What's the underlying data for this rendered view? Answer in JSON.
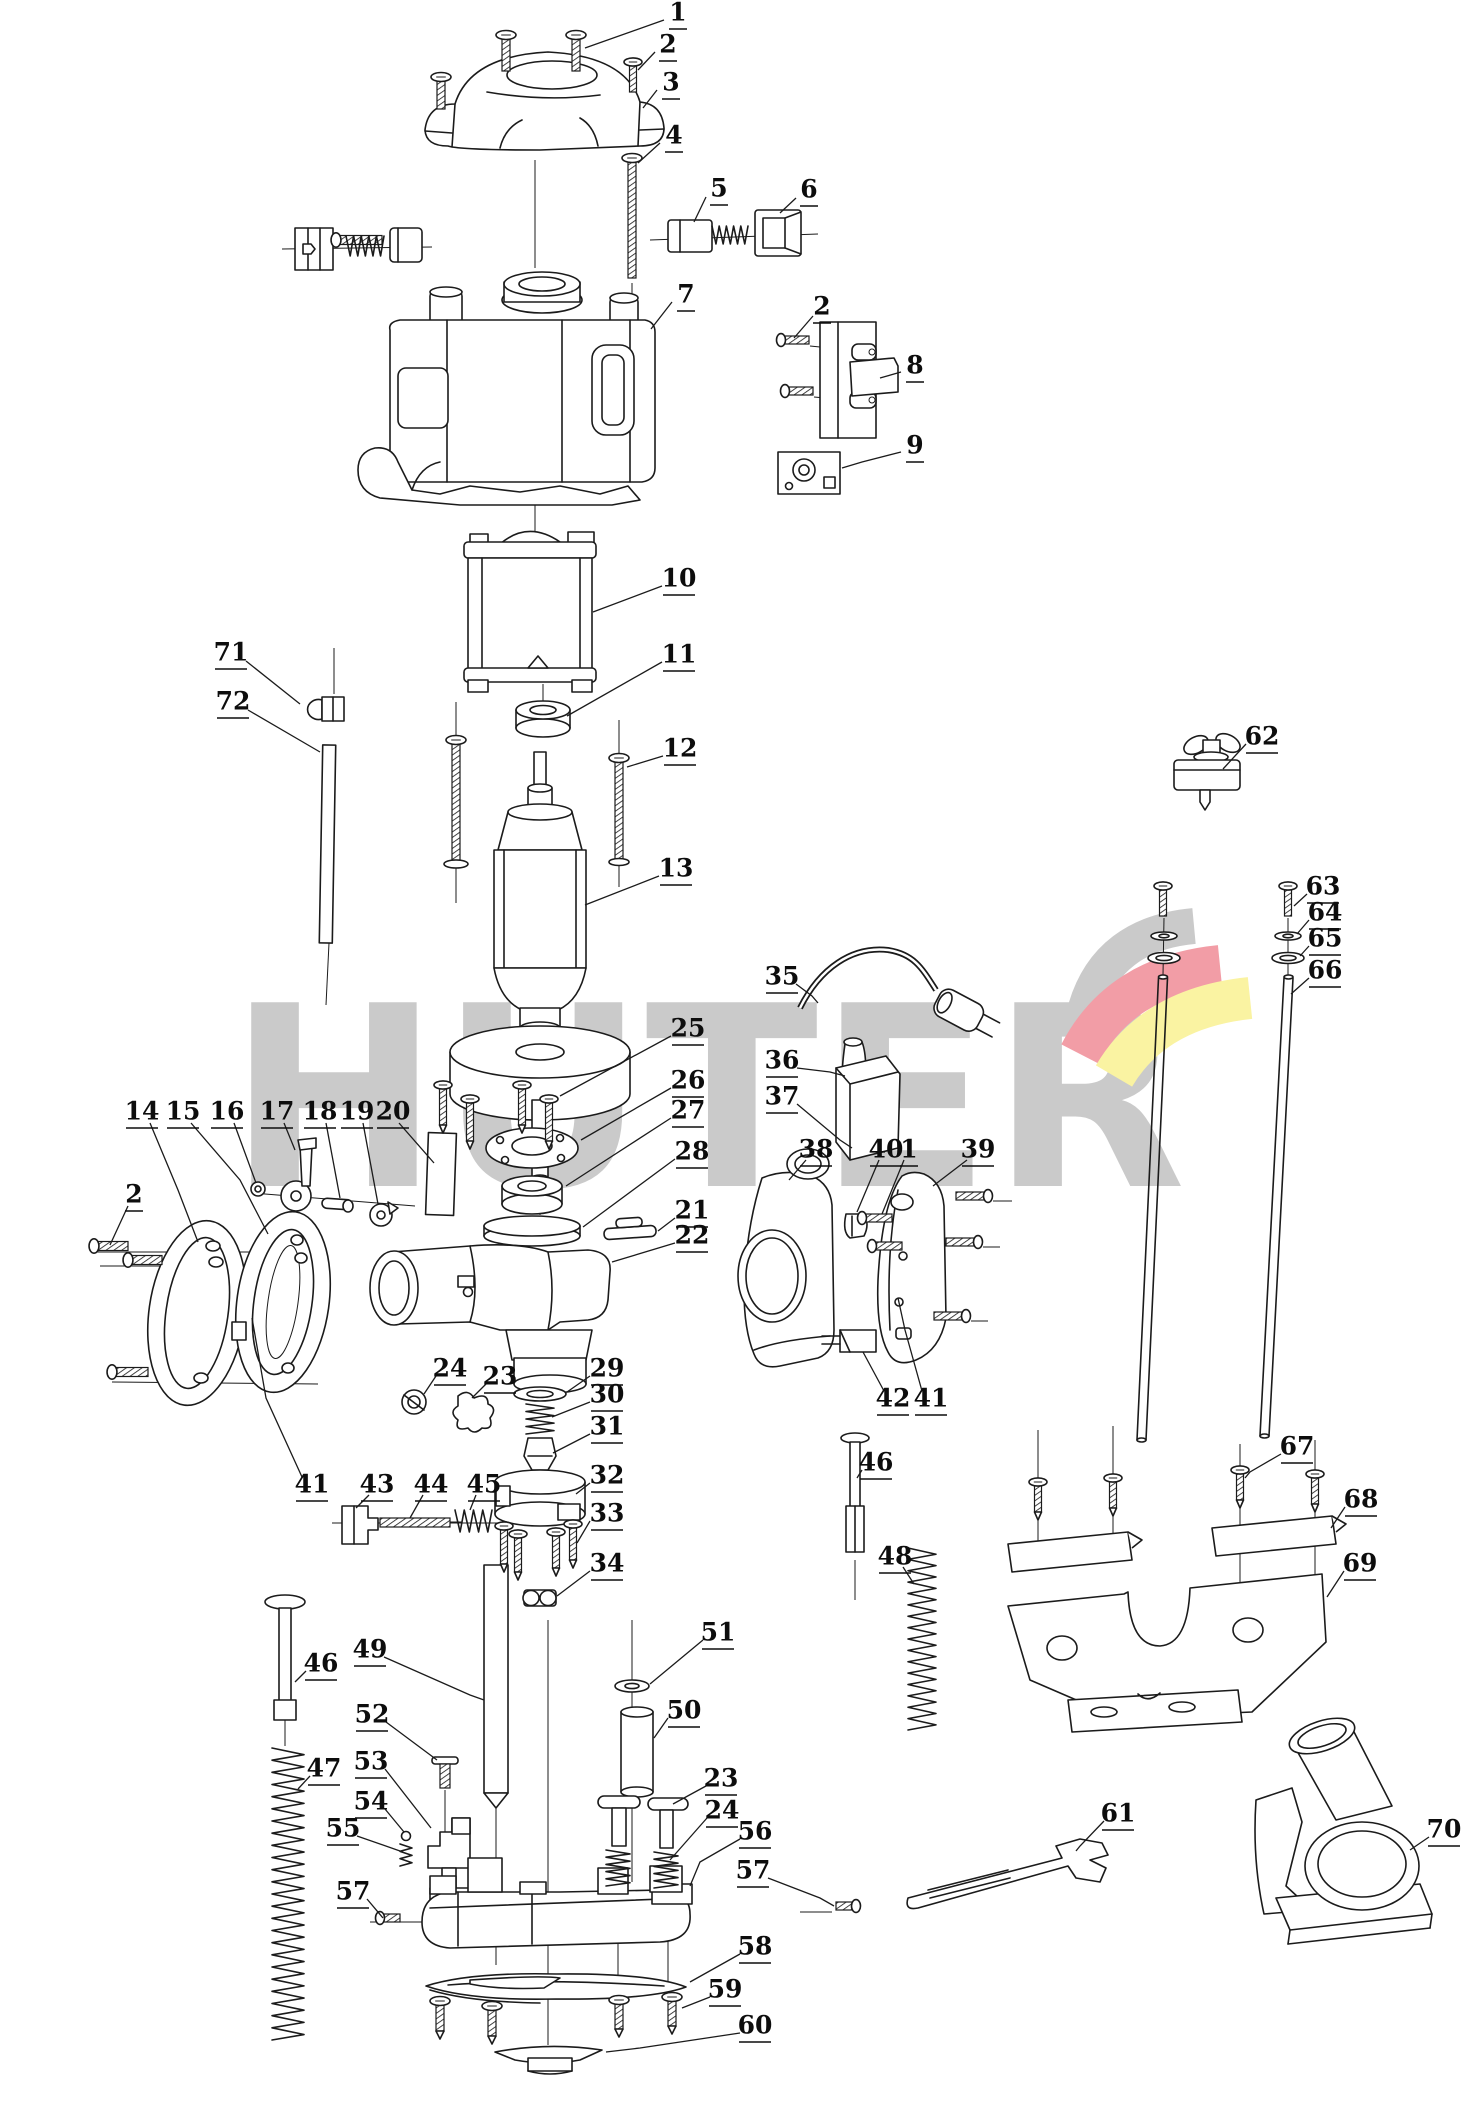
{
  "watermark": {
    "text": "HÜTER",
    "color": "#cacaca",
    "swoosh_gray": "#cacaca",
    "swoosh_red": "#f29da6",
    "swoosh_yellow": "#faf3a2"
  },
  "labels": [
    {
      "n": "1",
      "x": 678,
      "y": 14,
      "l": [
        664,
        20,
        585,
        48
      ]
    },
    {
      "n": "2",
      "x": 668,
      "y": 46,
      "l": [
        655,
        52,
        638,
        70
      ]
    },
    {
      "n": "3",
      "x": 671,
      "y": 84,
      "l": [
        657,
        90,
        643,
        108
      ]
    },
    {
      "n": "4",
      "x": 674,
      "y": 137,
      "l": [
        660,
        143,
        638,
        163
      ]
    },
    {
      "n": "5",
      "x": 719,
      "y": 190,
      "l": [
        706,
        197,
        694,
        222
      ]
    },
    {
      "n": "6",
      "x": 809,
      "y": 191,
      "l": [
        796,
        198,
        780,
        213
      ]
    },
    {
      "n": "7",
      "x": 686,
      "y": 296,
      "l": [
        672,
        302,
        651,
        329
      ]
    },
    {
      "n": "2",
      "x": 822,
      "y": 308,
      "l": [
        813,
        316,
        794,
        338
      ]
    },
    {
      "n": "8",
      "x": 915,
      "y": 367,
      "l": [
        901,
        372,
        880,
        378
      ]
    },
    {
      "n": "9",
      "x": 915,
      "y": 447,
      "l": [
        901,
        452,
        862,
        462,
        842,
        468
      ]
    },
    {
      "n": "10",
      "x": 679,
      "y": 580,
      "l": [
        662,
        586,
        593,
        612
      ]
    },
    {
      "n": "11",
      "x": 679,
      "y": 656,
      "l": [
        662,
        662,
        567,
        716
      ]
    },
    {
      "n": "12",
      "x": 680,
      "y": 750,
      "l": [
        663,
        756,
        627,
        767
      ]
    },
    {
      "n": "13",
      "x": 676,
      "y": 870,
      "l": [
        659,
        876,
        585,
        905
      ]
    },
    {
      "n": "71",
      "x": 231,
      "y": 654,
      "l": [
        246,
        661,
        300,
        704
      ]
    },
    {
      "n": "72",
      "x": 233,
      "y": 703,
      "l": [
        248,
        710,
        320,
        752
      ]
    },
    {
      "n": "62",
      "x": 1262,
      "y": 738,
      "l": [
        1246,
        744,
        1223,
        769
      ]
    },
    {
      "n": "63",
      "x": 1323,
      "y": 888,
      "l": [
        1307,
        894,
        1294,
        906
      ]
    },
    {
      "n": "64",
      "x": 1325,
      "y": 914,
      "l": [
        1309,
        920,
        1297,
        934
      ]
    },
    {
      "n": "65",
      "x": 1325,
      "y": 940,
      "l": [
        1309,
        946,
        1300,
        956
      ]
    },
    {
      "n": "66",
      "x": 1325,
      "y": 972,
      "l": [
        1309,
        978,
        1291,
        994
      ]
    },
    {
      "n": "35",
      "x": 782,
      "y": 978,
      "l": [
        796,
        984,
        812,
        996,
        818,
        1003
      ]
    },
    {
      "n": "36",
      "x": 782,
      "y": 1062,
      "l": [
        797,
        1068,
        830,
        1072,
        845,
        1076
      ]
    },
    {
      "n": "37",
      "x": 782,
      "y": 1098,
      "l": [
        797,
        1104,
        840,
        1140,
        852,
        1148
      ]
    },
    {
      "n": "25",
      "x": 688,
      "y": 1030,
      "l": [
        671,
        1036,
        560,
        1096
      ]
    },
    {
      "n": "26",
      "x": 688,
      "y": 1082,
      "l": [
        671,
        1088,
        581,
        1140
      ]
    },
    {
      "n": "27",
      "x": 688,
      "y": 1112,
      "l": [
        671,
        1118,
        566,
        1186
      ]
    },
    {
      "n": "28",
      "x": 692,
      "y": 1153,
      "l": [
        675,
        1159,
        583,
        1227
      ]
    },
    {
      "n": "21",
      "x": 692,
      "y": 1212,
      "l": [
        675,
        1218,
        658,
        1231
      ]
    },
    {
      "n": "22",
      "x": 692,
      "y": 1237,
      "l": [
        675,
        1243,
        612,
        1262
      ]
    },
    {
      "n": "14",
      "x": 142,
      "y": 1113,
      "l": [
        150,
        1123,
        178,
        1190,
        198,
        1242
      ]
    },
    {
      "n": "15",
      "x": 183,
      "y": 1113,
      "l": [
        191,
        1123,
        240,
        1180,
        268,
        1234
      ]
    },
    {
      "n": "16",
      "x": 227,
      "y": 1113,
      "l": [
        234,
        1123,
        256,
        1183
      ]
    },
    {
      "n": "17",
      "x": 277,
      "y": 1113,
      "l": [
        284,
        1123,
        295,
        1150
      ]
    },
    {
      "n": "18",
      "x": 320,
      "y": 1113,
      "l": [
        326,
        1123,
        340,
        1198
      ]
    },
    {
      "n": "19",
      "x": 357,
      "y": 1113,
      "l": [
        363,
        1123,
        378,
        1204
      ]
    },
    {
      "n": "20",
      "x": 393,
      "y": 1113,
      "l": [
        399,
        1123,
        434,
        1163
      ]
    },
    {
      "n": "2",
      "x": 134,
      "y": 1196,
      "l": [
        128,
        1206,
        110,
        1245
      ]
    },
    {
      "n": "38",
      "x": 816,
      "y": 1151,
      "l": [
        806,
        1160,
        789,
        1180
      ]
    },
    {
      "n": "40",
      "x": 886,
      "y": 1151,
      "l": [
        879,
        1160,
        857,
        1212
      ]
    },
    {
      "n": "1",
      "x": 909,
      "y": 1151,
      "l": [
        904,
        1160,
        882,
        1214
      ]
    },
    {
      "n": "39",
      "x": 978,
      "y": 1151,
      "l": [
        967,
        1160,
        933,
        1186
      ]
    },
    {
      "n": "42",
      "x": 893,
      "y": 1400,
      "l": [
        884,
        1391,
        863,
        1352
      ]
    },
    {
      "n": "41",
      "x": 931,
      "y": 1400,
      "l": [
        922,
        1391,
        905,
        1330,
        898,
        1298
      ]
    },
    {
      "n": "29",
      "x": 607,
      "y": 1370,
      "l": [
        590,
        1376,
        567,
        1392
      ]
    },
    {
      "n": "30",
      "x": 607,
      "y": 1396,
      "l": [
        590,
        1402,
        552,
        1417
      ]
    },
    {
      "n": "31",
      "x": 607,
      "y": 1428,
      "l": [
        590,
        1434,
        553,
        1453
      ]
    },
    {
      "n": "32",
      "x": 607,
      "y": 1477,
      "l": [
        590,
        1483,
        576,
        1494
      ]
    },
    {
      "n": "33",
      "x": 607,
      "y": 1515,
      "l": [
        590,
        1521,
        577,
        1543
      ]
    },
    {
      "n": "34",
      "x": 607,
      "y": 1565,
      "l": [
        590,
        1571,
        557,
        1596
      ]
    },
    {
      "n": "41",
      "x": 312,
      "y": 1486,
      "l": [
        302,
        1477,
        266,
        1398,
        252,
        1318
      ]
    },
    {
      "n": "43",
      "x": 377,
      "y": 1486,
      "l": [
        369,
        1495,
        356,
        1508
      ]
    },
    {
      "n": "44",
      "x": 431,
      "y": 1486,
      "l": [
        423,
        1495,
        410,
        1518
      ]
    },
    {
      "n": "45",
      "x": 484,
      "y": 1486,
      "l": [
        476,
        1495,
        470,
        1510
      ]
    },
    {
      "n": "46",
      "x": 876,
      "y": 1464,
      "l": [
        862,
        1470,
        857,
        1478
      ]
    },
    {
      "n": "48",
      "x": 895,
      "y": 1558,
      "l": [
        903,
        1567,
        914,
        1584
      ]
    },
    {
      "n": "67",
      "x": 1297,
      "y": 1448,
      "l": [
        1281,
        1454,
        1250,
        1472,
        1245,
        1478
      ]
    },
    {
      "n": "68",
      "x": 1361,
      "y": 1501,
      "l": [
        1345,
        1507,
        1331,
        1528
      ]
    },
    {
      "n": "69",
      "x": 1360,
      "y": 1565,
      "l": [
        1344,
        1571,
        1327,
        1597
      ]
    },
    {
      "n": "46",
      "x": 321,
      "y": 1665,
      "l": [
        306,
        1671,
        295,
        1682
      ]
    },
    {
      "n": "49",
      "x": 370,
      "y": 1651,
      "l": [
        384,
        1657,
        470,
        1695,
        484,
        1700
      ]
    },
    {
      "n": "47",
      "x": 324,
      "y": 1770,
      "l": [
        310,
        1776,
        298,
        1789
      ]
    },
    {
      "n": "52",
      "x": 372,
      "y": 1716,
      "l": [
        386,
        1722,
        437,
        1760
      ]
    },
    {
      "n": "53",
      "x": 371,
      "y": 1763,
      "l": [
        385,
        1769,
        431,
        1828
      ]
    },
    {
      "n": "54",
      "x": 371,
      "y": 1803,
      "l": [
        385,
        1809,
        404,
        1832
      ]
    },
    {
      "n": "55",
      "x": 343,
      "y": 1830,
      "l": [
        357,
        1836,
        400,
        1851
      ]
    },
    {
      "n": "57",
      "x": 353,
      "y": 1893,
      "l": [
        367,
        1899,
        383,
        1918
      ]
    },
    {
      "n": "51",
      "x": 718,
      "y": 1634,
      "l": [
        703,
        1640,
        650,
        1684
      ]
    },
    {
      "n": "50",
      "x": 684,
      "y": 1712,
      "l": [
        668,
        1718,
        654,
        1738
      ]
    },
    {
      "n": "23",
      "x": 500,
      "y": 1378,
      "l": [
        486,
        1384,
        472,
        1398
      ]
    },
    {
      "n": "24",
      "x": 450,
      "y": 1370,
      "l": [
        436,
        1376,
        424,
        1394
      ]
    },
    {
      "n": "23",
      "x": 721,
      "y": 1780,
      "l": [
        706,
        1786,
        673,
        1804
      ]
    },
    {
      "n": "24",
      "x": 722,
      "y": 1812,
      "l": [
        707,
        1818,
        670,
        1860
      ]
    },
    {
      "n": "56",
      "x": 755,
      "y": 1833,
      "l": [
        740,
        1839,
        700,
        1862,
        690,
        1886
      ]
    },
    {
      "n": "57",
      "x": 753,
      "y": 1872,
      "l": [
        768,
        1878,
        820,
        1898,
        834,
        1906
      ]
    },
    {
      "n": "58",
      "x": 755,
      "y": 1948,
      "l": [
        740,
        1954,
        690,
        1982
      ]
    },
    {
      "n": "59",
      "x": 725,
      "y": 1991,
      "l": [
        710,
        1997,
        682,
        2008
      ]
    },
    {
      "n": "60",
      "x": 755,
      "y": 2027,
      "l": [
        740,
        2033,
        640,
        2048,
        606,
        2052
      ]
    },
    {
      "n": "61",
      "x": 1118,
      "y": 1815,
      "l": [
        1104,
        1821,
        1080,
        1846,
        1076,
        1851
      ]
    },
    {
      "n": "70",
      "x": 1444,
      "y": 1831,
      "l": [
        1429,
        1837,
        1410,
        1850
      ]
    }
  ]
}
